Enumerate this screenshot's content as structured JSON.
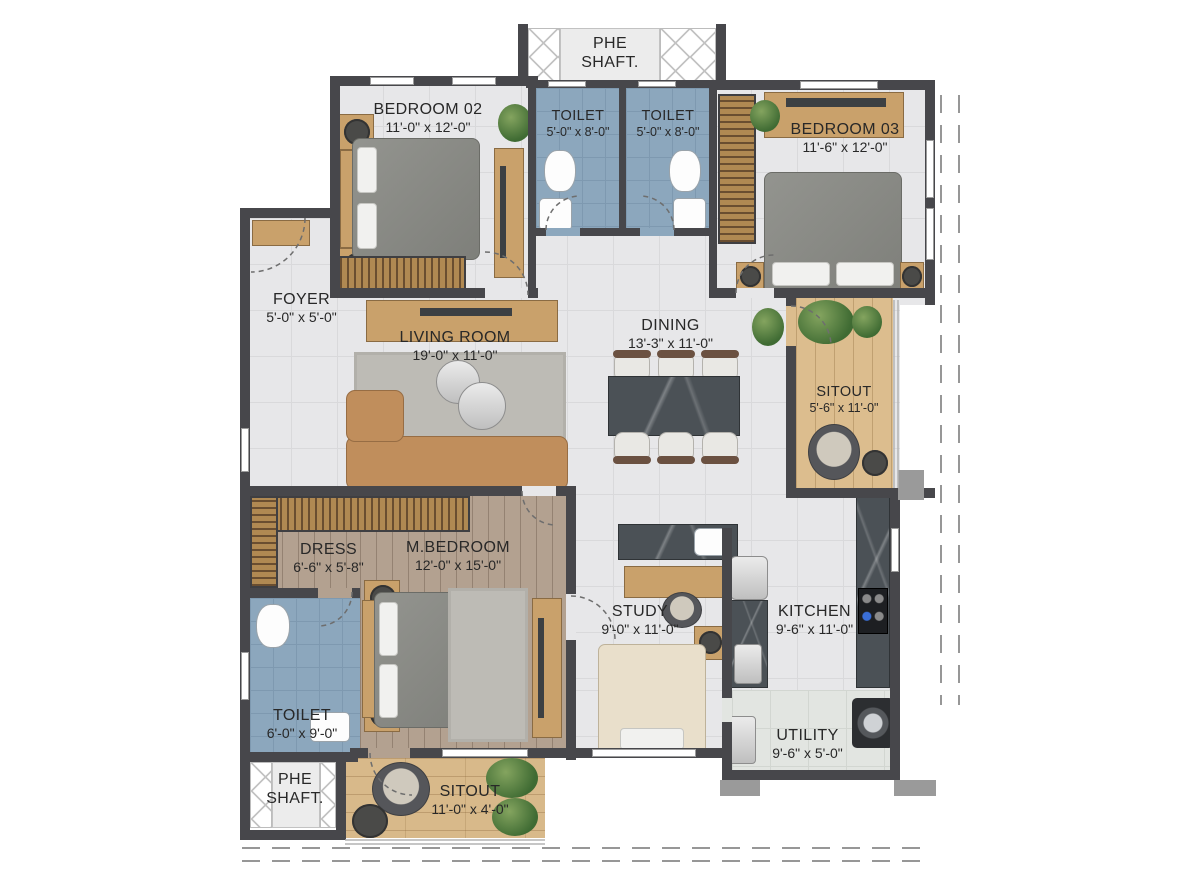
{
  "rooms": {
    "phe_top": {
      "line1": "PHE",
      "line2": "SHAFT."
    },
    "bedroom02": {
      "label": "BEDROOM 02",
      "dims": "11'-0\" x 12'-0\""
    },
    "toilet_a": {
      "label": "TOILET",
      "dims": "5'-0\" x 8'-0\""
    },
    "toilet_b": {
      "label": "TOILET",
      "dims": "5'-0\" x 8'-0\""
    },
    "bedroom03": {
      "label": "BEDROOM 03",
      "dims": "11'-6\" x 12'-0\""
    },
    "foyer": {
      "label": "FOYER",
      "dims": "5'-0\" x 5'-0\""
    },
    "living": {
      "label": "LIVING ROOM",
      "dims": "19'-0\" x 11'-0\""
    },
    "dining": {
      "label": "DINING",
      "dims": "13'-3\" x 11'-0\""
    },
    "sitout_right": {
      "label": "SITOUT",
      "dims": "5'-6\" x 11'-0\""
    },
    "dress": {
      "label": "DRESS",
      "dims": "6'-6\" x 5'-8\""
    },
    "m_bedroom": {
      "label": "M.BEDROOM",
      "dims": "12'-0\" x 15'-0\""
    },
    "study": {
      "label": "STUDY",
      "dims": "9'-0\" x 11'-0\""
    },
    "kitchen": {
      "label": "KITCHEN",
      "dims": "9'-6\" x 11'-0\""
    },
    "utility": {
      "label": "UTILITY",
      "dims": "9'-6\" x 5'-0\""
    },
    "toilet_master": {
      "label": "TOILET",
      "dims": "6'-0\" x 9'-0\""
    },
    "phe_bottom": {
      "line1": "PHE",
      "line2": "SHAFT."
    },
    "sitout_bottom": {
      "label": "SITOUT",
      "dims": "11'-0\" x 4'-0\""
    }
  },
  "colors": {
    "wall": "#47474b",
    "toilet_tile": "#8ca7bd",
    "wood_light": "#dcbd8e",
    "wood_dark": "#b3a190",
    "counter": "#4b5156"
  }
}
